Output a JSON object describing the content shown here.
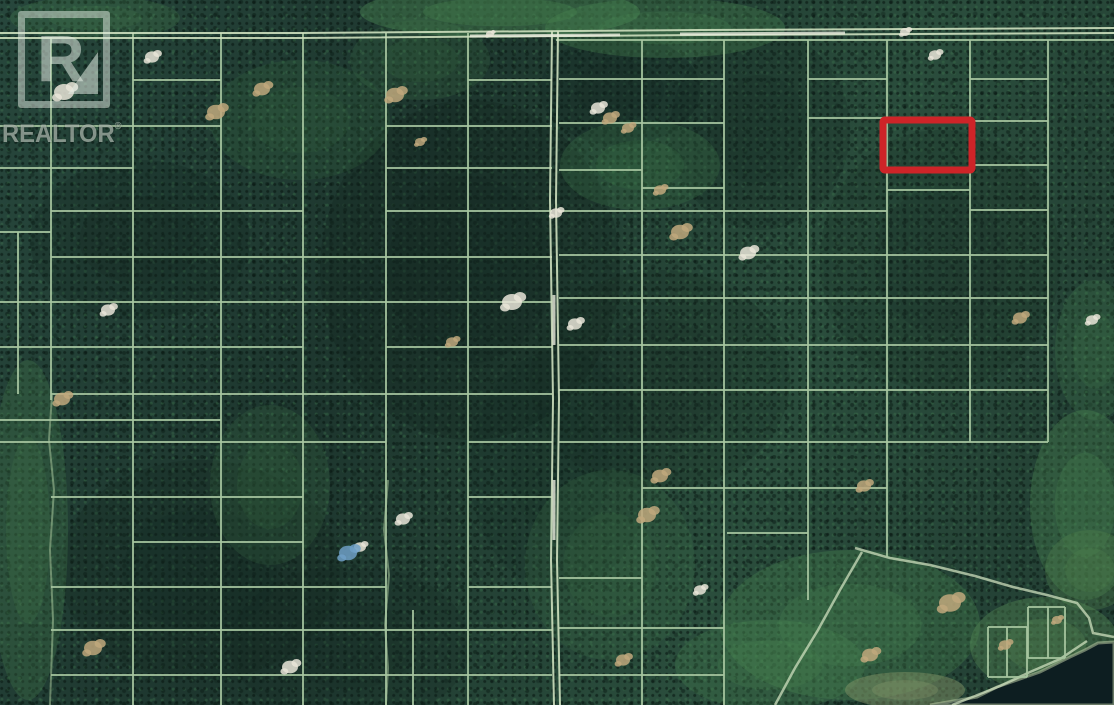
{
  "watermark": {
    "letter": "R",
    "brand": "REALTOR",
    "registered": "®"
  },
  "map": {
    "width": 1114,
    "height": 705,
    "colors": {
      "parcel_line": "#a7c6a0",
      "road_line": "#cddfbe",
      "road_bright": "#e9ebdd",
      "trail": "#9cbb92",
      "highlight": "#ce2428",
      "water": "#0d1e21",
      "shore": "#b7c6a0",
      "clearing_tan": "#c0a87d",
      "clearing_white": "#e9e5d8",
      "clearing_blue": "#6f9fc6",
      "patch_dark": "#122620"
    },
    "highlight_parcel": {
      "x": 883,
      "y": 120,
      "width": 89,
      "height": 50,
      "stroke_width": 7
    },
    "roads": {
      "horizontal_top": {
        "points": [
          [
            0,
            33
          ],
          [
            300,
            33
          ],
          [
            700,
            30
          ],
          [
            1114,
            28
          ]
        ],
        "offset": 5
      },
      "vertical_main": {
        "points": [
          [
            552,
            31
          ],
          [
            550,
            200
          ],
          [
            553,
            400
          ],
          [
            551,
            560
          ],
          [
            554,
            705
          ]
        ],
        "offset": 6
      },
      "bright_segments": [
        [
          470,
          36,
          620,
          35
        ],
        [
          680,
          34,
          845,
          33
        ],
        [
          554,
          295,
          554,
          345
        ],
        [
          554,
          480,
          554,
          540
        ]
      ],
      "winding": [
        [
          855,
          548
        ],
        [
          890,
          558
        ],
        [
          930,
          565
        ],
        [
          975,
          576
        ],
        [
          1013,
          587
        ],
        [
          1047,
          595
        ],
        [
          1077,
          603
        ],
        [
          1089,
          618
        ],
        [
          1093,
          633
        ],
        [
          1114,
          637
        ]
      ],
      "winding_branch": [
        [
          862,
          552
        ],
        [
          840,
          590
        ],
        [
          818,
          630
        ],
        [
          795,
          668
        ],
        [
          775,
          705
        ]
      ],
      "shore_path": [
        [
          1087,
          641
        ],
        [
          1060,
          659
        ],
        [
          1030,
          672
        ],
        [
          1000,
          686
        ],
        [
          975,
          696
        ],
        [
          952,
          705
        ]
      ]
    },
    "trails": [
      {
        "points": [
          [
            52,
            395
          ],
          [
            49,
            440
          ],
          [
            54,
            490
          ],
          [
            50,
            550
          ],
          [
            53,
            620
          ],
          [
            50,
            705
          ]
        ]
      },
      {
        "points": [
          [
            388,
            480
          ],
          [
            384,
            530
          ],
          [
            389,
            575
          ],
          [
            385,
            625
          ],
          [
            388,
            668
          ],
          [
            386,
            705
          ]
        ]
      }
    ],
    "parcel_lines": {
      "vertical": [
        [
          18,
          232,
          394
        ],
        [
          51,
          37,
          400
        ],
        [
          133,
          33,
          705
        ],
        [
          221,
          33,
          705
        ],
        [
          303,
          33,
          705
        ],
        [
          386,
          33,
          705
        ],
        [
          468,
          33,
          705
        ],
        [
          642,
          40,
          705
        ],
        [
          724,
          40,
          705
        ],
        [
          808,
          40,
          600
        ],
        [
          887,
          40,
          557
        ],
        [
          970,
          40,
          442
        ],
        [
          1048,
          40,
          442
        ],
        [
          413,
          610,
          705
        ],
        [
          988,
          627,
          677
        ],
        [
          1007,
          627,
          677
        ],
        [
          1027,
          627,
          677
        ],
        [
          1028,
          607,
          658
        ],
        [
          1048,
          607,
          658
        ],
        [
          1065,
          607,
          658
        ]
      ],
      "horizontal": [
        [
          40,
          556,
          1114
        ],
        [
          80,
          133,
          221
        ],
        [
          80,
          468,
          552
        ],
        [
          79,
          559,
          724
        ],
        [
          79,
          808,
          887
        ],
        [
          79,
          970,
          1048
        ],
        [
          118,
          808,
          970
        ],
        [
          121,
          970,
          1048
        ],
        [
          123,
          559,
          724
        ],
        [
          126,
          0,
          221
        ],
        [
          126,
          386,
          552
        ],
        [
          165,
          970,
          1048
        ],
        [
          168,
          0,
          133
        ],
        [
          168,
          386,
          552
        ],
        [
          170,
          559,
          642
        ],
        [
          188,
          642,
          724
        ],
        [
          190,
          887,
          970
        ],
        [
          211,
          51,
          303
        ],
        [
          211,
          386,
          552
        ],
        [
          211,
          559,
          887
        ],
        [
          210,
          970,
          1048
        ],
        [
          232,
          0,
          51
        ],
        [
          255,
          559,
          1048
        ],
        [
          257,
          51,
          552
        ],
        [
          298,
          559,
          1048
        ],
        [
          302,
          0,
          552
        ],
        [
          345,
          559,
          1048
        ],
        [
          347,
          0,
          303
        ],
        [
          347,
          386,
          552
        ],
        [
          390,
          559,
          1048
        ],
        [
          394,
          51,
          552
        ],
        [
          420,
          0,
          221
        ],
        [
          442,
          0,
          386
        ],
        [
          442,
          468,
          552
        ],
        [
          442,
          559,
          1048
        ],
        [
          488,
          642,
          887
        ],
        [
          497,
          51,
          303
        ],
        [
          497,
          468,
          552
        ],
        [
          533,
          727,
          808
        ],
        [
          542,
          133,
          303
        ],
        [
          578,
          559,
          642
        ],
        [
          587,
          51,
          386
        ],
        [
          587,
          468,
          552
        ],
        [
          628,
          559,
          724
        ],
        [
          630,
          51,
          552
        ],
        [
          675,
          51,
          552
        ],
        [
          675,
          559,
          724
        ],
        [
          627,
          988,
          1027
        ],
        [
          677,
          988,
          1027
        ],
        [
          607,
          1028,
          1065
        ],
        [
          658,
          1028,
          1065
        ]
      ]
    },
    "patches": [
      [
        470,
        270,
        150,
        170,
        "#122620",
        0.32
      ],
      [
        140,
        240,
        110,
        80,
        "#122620",
        0.28
      ],
      [
        620,
        90,
        80,
        55,
        "#122620",
        0.3
      ],
      [
        760,
        130,
        90,
        100,
        "#122620",
        0.22
      ],
      [
        940,
        260,
        120,
        130,
        "#122620",
        0.2
      ],
      [
        200,
        570,
        140,
        110,
        "#122620",
        0.26
      ],
      [
        660,
        380,
        130,
        110,
        "#122620",
        0.2
      ],
      [
        350,
        645,
        120,
        80,
        "#122620",
        0.22
      ],
      [
        560,
        470,
        90,
        120,
        "#122620",
        0.18
      ],
      [
        500,
        12,
        140,
        26,
        "#4d8b54",
        0.4
      ],
      [
        665,
        28,
        120,
        30,
        "#4d8b54",
        0.3
      ],
      [
        640,
        165,
        80,
        45,
        "#3f7a4a",
        0.25
      ],
      [
        28,
        530,
        40,
        170,
        "#48824f",
        0.28
      ],
      [
        270,
        485,
        60,
        80,
        "#3f7a4a",
        0.2
      ],
      [
        850,
        625,
        130,
        75,
        "#4d8b54",
        0.3
      ],
      [
        1085,
        505,
        55,
        95,
        "#4d8b54",
        0.32
      ],
      [
        1090,
        570,
        45,
        40,
        "#55884f",
        0.3
      ],
      [
        1045,
        645,
        75,
        48,
        "#5d9258",
        0.35
      ],
      [
        95,
        18,
        85,
        22,
        "#4d8b54",
        0.22
      ],
      [
        610,
        565,
        85,
        95,
        "#3f7a4a",
        0.2
      ],
      [
        770,
        665,
        95,
        45,
        "#4d8b54",
        0.25
      ],
      [
        1095,
        350,
        40,
        70,
        "#4d8b54",
        0.2
      ],
      [
        905,
        690,
        60,
        18,
        "#8a9a6b",
        0.45
      ],
      [
        300,
        120,
        90,
        60,
        "#3f7a4a",
        0.18
      ],
      [
        420,
        60,
        70,
        40,
        "#3f7a4a",
        0.2
      ]
    ],
    "clearings": [
      [
        64,
        92,
        10,
        "white"
      ],
      [
        152,
        57,
        7,
        "white"
      ],
      [
        748,
        253,
        8,
        "white"
      ],
      [
        512,
        302,
        10,
        "white"
      ],
      [
        556,
        213,
        6,
        "white"
      ],
      [
        575,
        324,
        7,
        "white"
      ],
      [
        108,
        310,
        7,
        "white"
      ],
      [
        290,
        667,
        8,
        "white"
      ],
      [
        360,
        547,
        6,
        "white"
      ],
      [
        403,
        519,
        7,
        "white"
      ],
      [
        700,
        590,
        6,
        "white"
      ],
      [
        1092,
        320,
        6,
        "white"
      ],
      [
        935,
        55,
        6,
        "white"
      ],
      [
        905,
        32,
        5,
        "white"
      ],
      [
        490,
        34,
        4,
        "white"
      ],
      [
        598,
        108,
        7,
        "white"
      ],
      [
        216,
        112,
        9,
        "tan"
      ],
      [
        262,
        89,
        8,
        "tan"
      ],
      [
        395,
        95,
        9,
        "tan"
      ],
      [
        420,
        142,
        5,
        "tan"
      ],
      [
        610,
        118,
        7,
        "tan"
      ],
      [
        628,
        128,
        6,
        "tan"
      ],
      [
        680,
        232,
        9,
        "tan"
      ],
      [
        62,
        399,
        8,
        "tan"
      ],
      [
        93,
        648,
        9,
        "tan"
      ],
      [
        660,
        476,
        8,
        "tan"
      ],
      [
        647,
        515,
        9,
        "tan"
      ],
      [
        623,
        660,
        7,
        "tan"
      ],
      [
        864,
        486,
        7,
        "tan"
      ],
      [
        950,
        603,
        11,
        "tan"
      ],
      [
        870,
        655,
        8,
        "tan"
      ],
      [
        660,
        190,
        6,
        "tan"
      ],
      [
        452,
        342,
        6,
        "tan"
      ],
      [
        1005,
        645,
        6,
        "tan"
      ],
      [
        1020,
        318,
        7,
        "tan"
      ],
      [
        1057,
        620,
        5,
        "tan"
      ],
      [
        348,
        553,
        9,
        "blue"
      ]
    ],
    "lake": {
      "points": [
        [
          930,
          705
        ],
        [
          977,
          697
        ],
        [
          997,
          687
        ],
        [
          1040,
          672
        ],
        [
          1070,
          657
        ],
        [
          1085,
          650
        ],
        [
          1098,
          643
        ],
        [
          1114,
          642
        ],
        [
          1114,
          705
        ]
      ]
    }
  }
}
